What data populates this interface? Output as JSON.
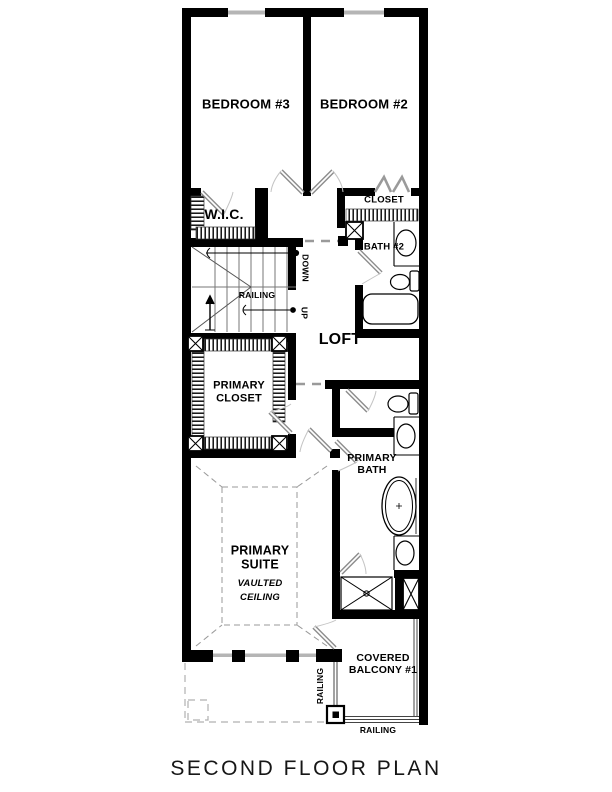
{
  "title": "SECOND FLOOR PLAN",
  "labels": {
    "bedroom3": "BEDROOM #3",
    "bedroom2": "BEDROOM #2",
    "wic": "W.I.C.",
    "closet": "CLOSET",
    "bath2": "BATH #2",
    "loft": "LOFT",
    "down": "DOWN",
    "up": "UP",
    "railing_stairs": "RAILING",
    "primary_closet": [
      "PRIMARY",
      "CLOSET"
    ],
    "primary_bath": [
      "PRIMARY",
      "BATH"
    ],
    "primary_suite": [
      "PRIMARY",
      "SUITE"
    ],
    "vaulted_ceiling": [
      "VAULTED",
      "CEILING"
    ],
    "covered_balcony": [
      "COVERED",
      "BALCONY #1"
    ],
    "railing_balcony_side": "RAILING",
    "railing_balcony_bottom": "RAILING"
  },
  "colors": {
    "wall": "#000000",
    "window": "#b5b5b5",
    "door_leaf": "#8c8c8c",
    "door_swing": "#c4c4c4",
    "dashed_line": "#9a9a9a",
    "thin_line": "#777777"
  }
}
